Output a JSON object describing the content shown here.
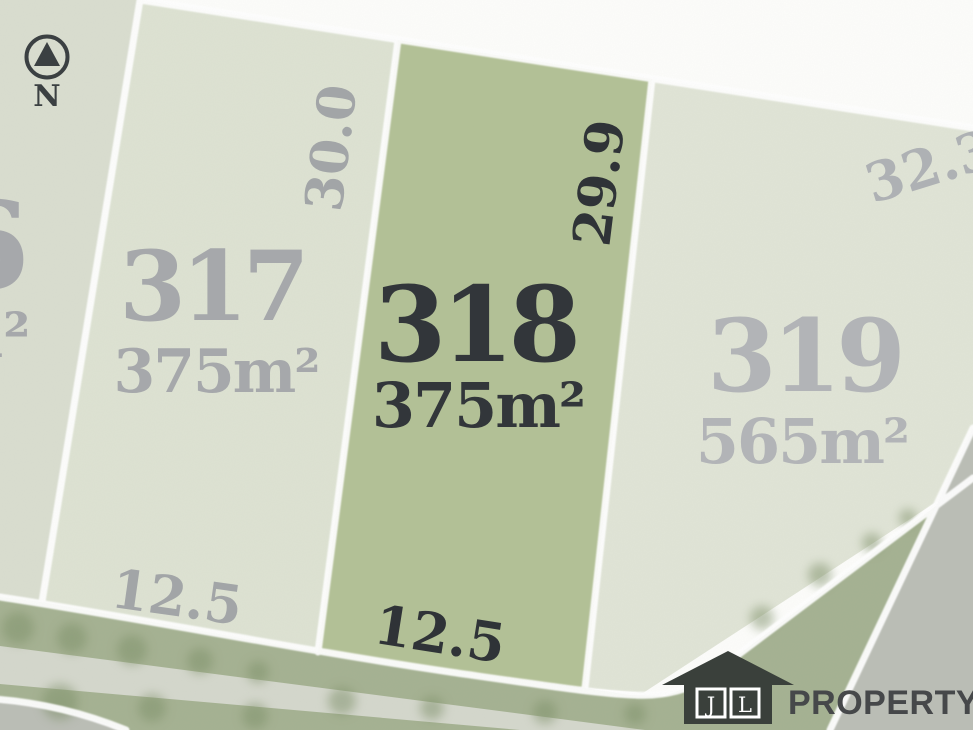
{
  "compass": {
    "label": "N"
  },
  "lots": {
    "lot316": {
      "number_partial": "6",
      "area_partial": "m²"
    },
    "lot317": {
      "number": "317",
      "area": "375m²",
      "side_length": "30.0",
      "frontage": "12.5"
    },
    "lot318": {
      "number": "318",
      "area": "375m²",
      "side_length": "29.9",
      "frontage": "12.5"
    },
    "lot319": {
      "number": "319",
      "area": "565m²",
      "side_length": "32.3"
    }
  },
  "logo": {
    "initial_left": "J",
    "initial_right": "L",
    "wordmark": "PROPERTY"
  },
  "colors": {
    "background_white": "#fdfdfb",
    "lot316_fill": "#d9ddcf",
    "lot317_fill": "#dde2d2",
    "lot318_fill": "#b2c095",
    "lot319_fill": "#e0e4d6",
    "boundary_line": "#ffffff",
    "verge_green": "#a4b191",
    "path_gray": "#d4d7cc",
    "road_gray": "#babdb5",
    "tree_green": "#7b8e66",
    "label_gray": "#a6a8ab",
    "label_gray_light": "#b2b4b7",
    "label_dim_gray": "#a2a5a7",
    "label_dark": "#32363a",
    "compass_dark": "#3b4042",
    "logo_dark": "#3a403b",
    "logo_text": "#46484a"
  }
}
